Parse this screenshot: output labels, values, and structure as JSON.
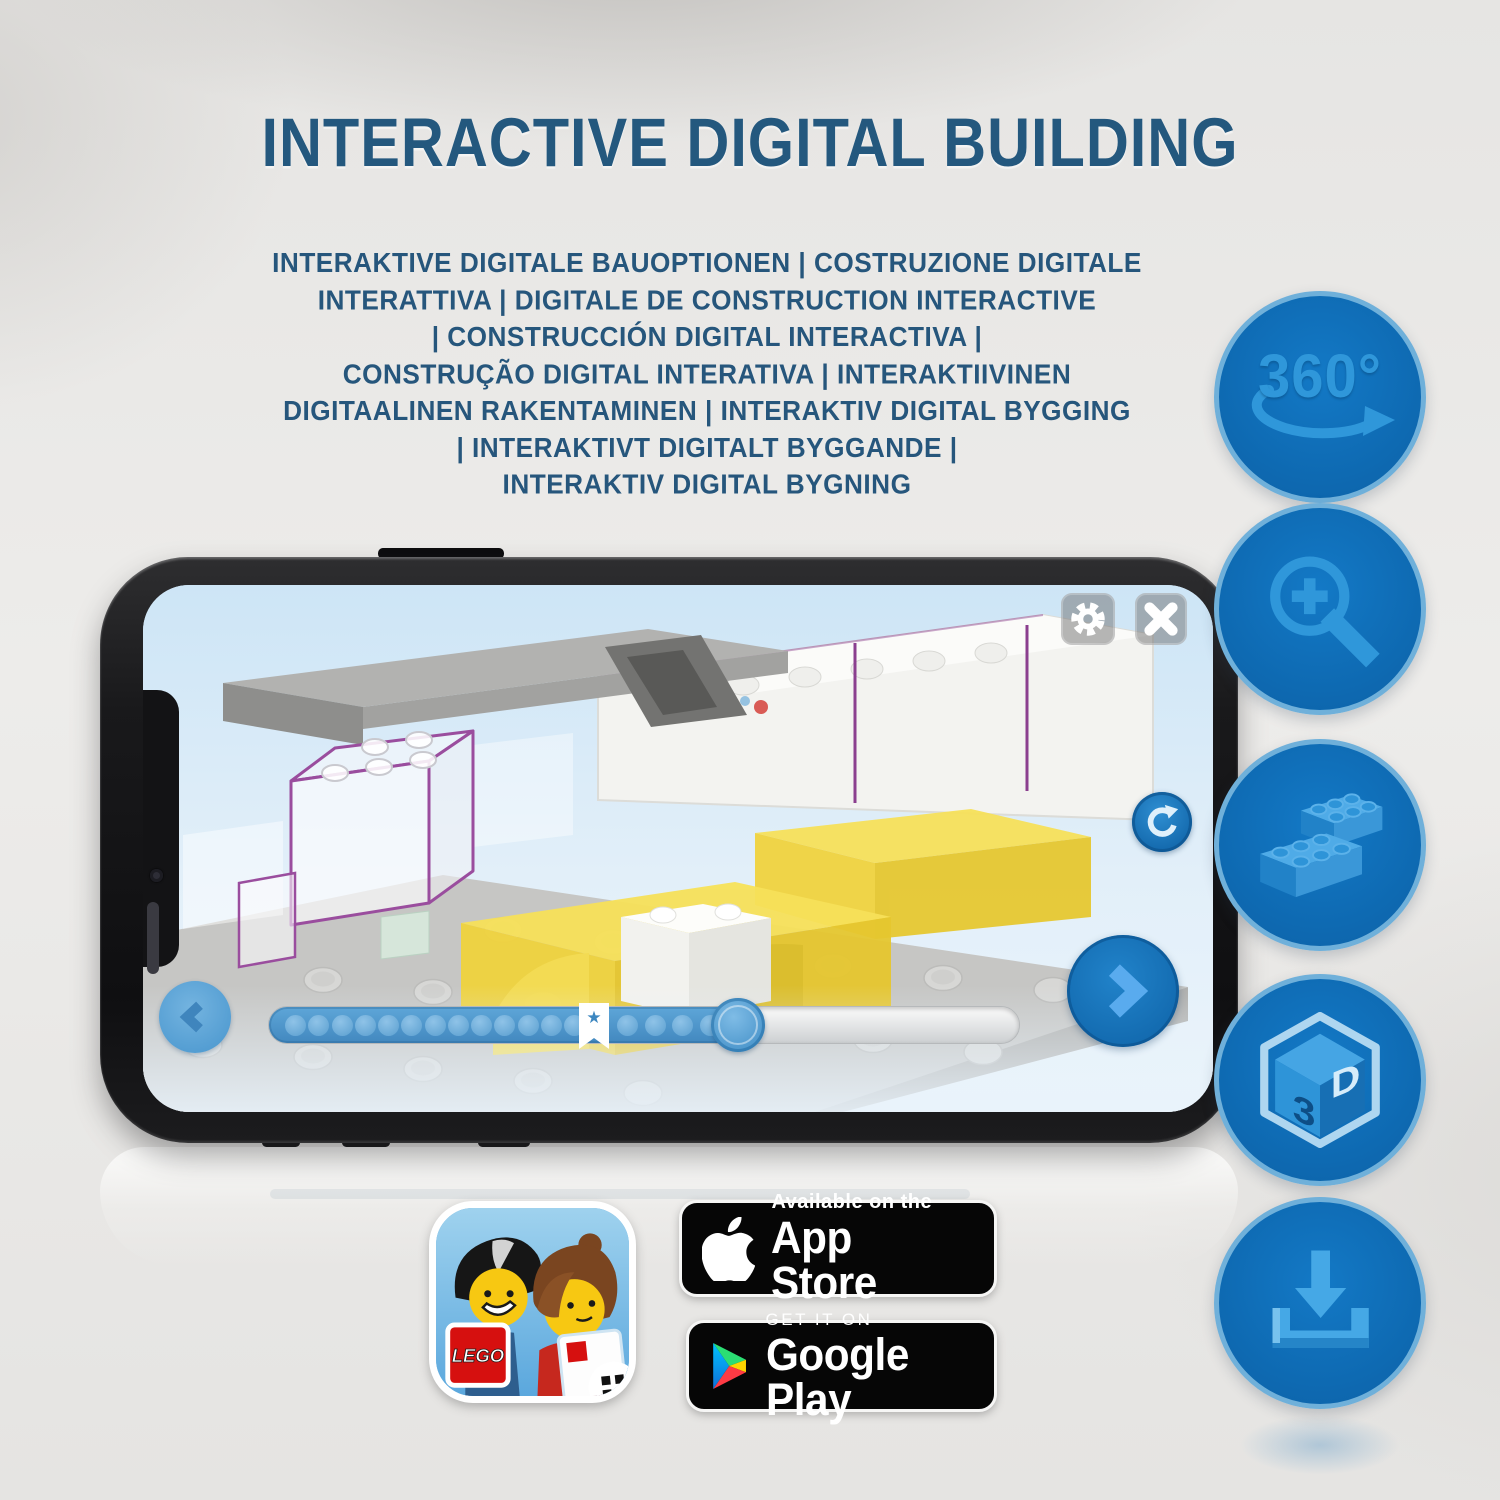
{
  "header": {
    "title": "INTERACTIVE DIGITAL BUILDING",
    "subtitle_lines": [
      "INTERAKTIVE DIGITALE BAUOPTIONEN | COSTRUZIONE DIGITALE",
      "INTERATTIVA | DIGITALE DE CONSTRUCTION INTERACTIVE",
      "| CONSTRUCCIÓN DIGITAL INTERACTIVA |",
      "CONSTRUÇÃO DIGITAL INTERATIVA | INTERAKTIIVINEN",
      "DIGITAALINEN RAKENTAMINEN | INTERAKTIV DIGITAL BYGGING",
      "| INTERAKTIVT DIGITALT BYGGANDE |",
      "INTERAKTIV DIGITAL BYGNING"
    ]
  },
  "features": {
    "rotate360": {
      "label": "360°"
    },
    "zoom_in": {
      "icon": "magnifier-plus"
    },
    "bricks": {
      "icon": "lego-bricks"
    },
    "cube3d": {
      "face_left": "3",
      "face_right": "D"
    },
    "download": {
      "icon": "download-tray"
    }
  },
  "phone_app": {
    "toolbar": {
      "settings_icon": "gear",
      "close_icon": "x"
    },
    "controls": {
      "back_icon": "chevron-left",
      "next_icon": "chevron-right",
      "rotate_icon": "rotate-arrow"
    },
    "progress": {
      "dots_before_bookmark": 13,
      "dots_after_bookmark": 4,
      "bookmark_icon": "★",
      "fill_percent": 62
    }
  },
  "badges": {
    "lego_app": {
      "logo_text": "LEGO"
    },
    "app_store": {
      "line1": "Available on the",
      "line2": "App Store"
    },
    "google_play": {
      "line1": "GET IT ON",
      "line2": "Google Play"
    }
  },
  "colors": {
    "title_blue": "#24587e",
    "feature_circle_blue": "#0f6fb8",
    "feature_glyph_blue": "#2f97da",
    "accent_blue": "#1878be",
    "brick_yellow": "#f2d949",
    "selection_purple": "#8b3f8f",
    "background_grey": "#e8e7e5"
  }
}
